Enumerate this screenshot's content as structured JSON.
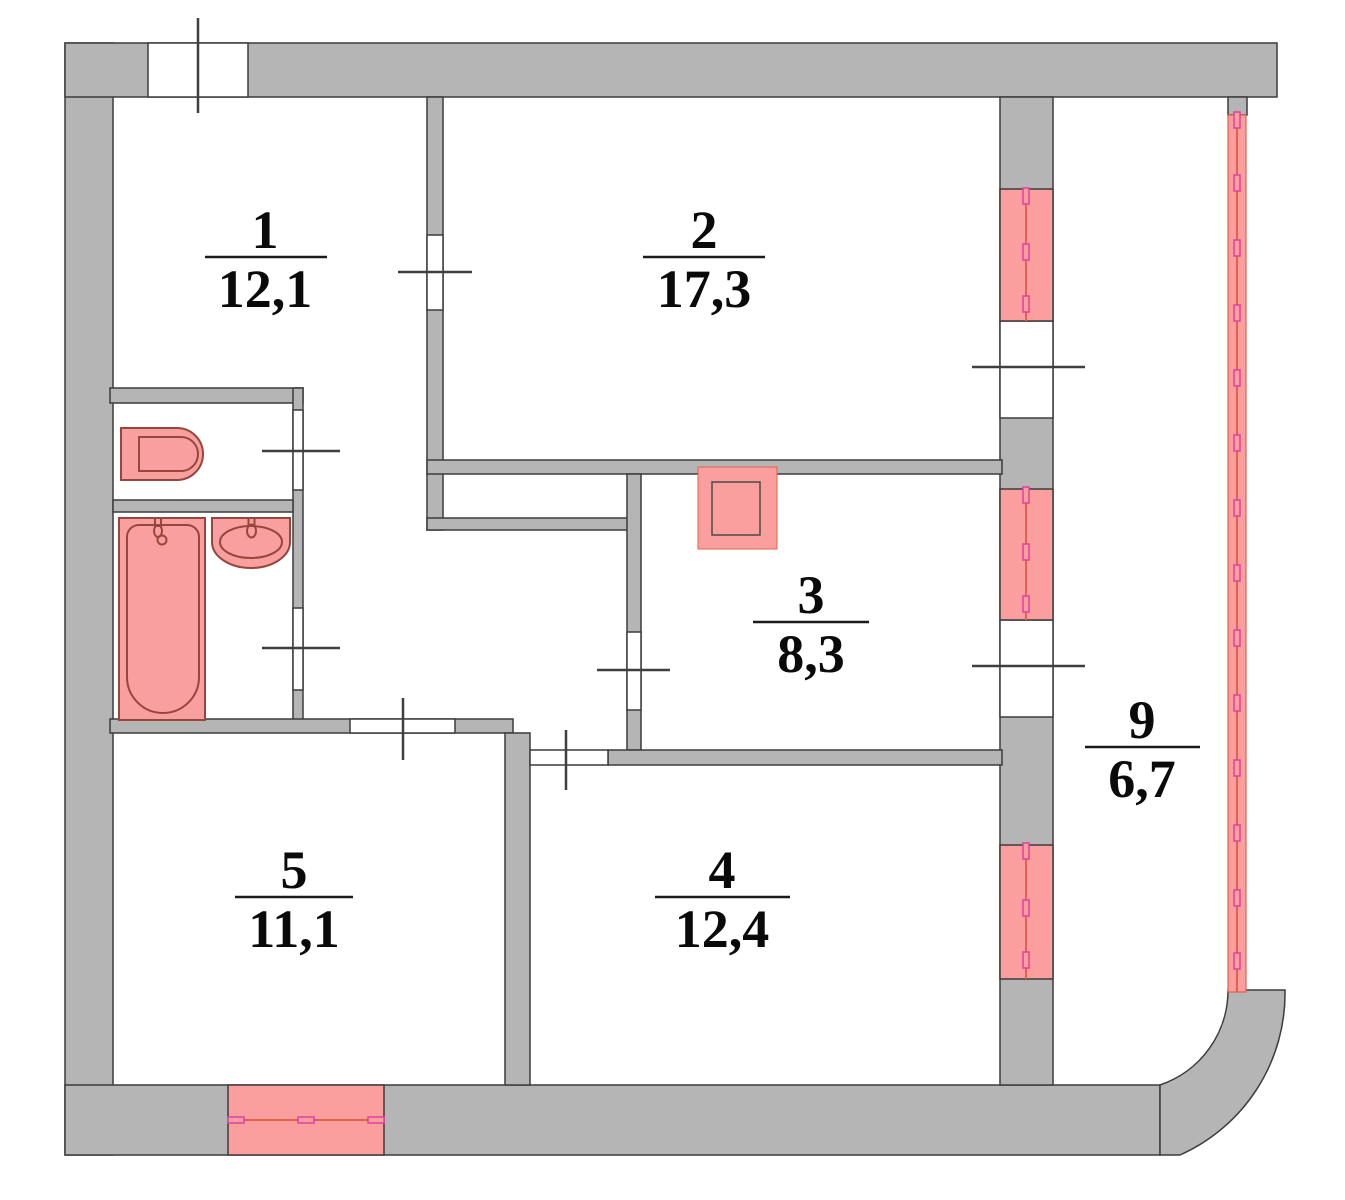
{
  "plan_title": "apartment floor plan",
  "rooms": {
    "r1": {
      "number": "1",
      "area": "12,1"
    },
    "r2": {
      "number": "2",
      "area": "17,3"
    },
    "r3": {
      "number": "3",
      "area": "8,3"
    },
    "r4": {
      "number": "4",
      "area": "12,4"
    },
    "r5": {
      "number": "5",
      "area": "11,1"
    },
    "r9": {
      "number": "9",
      "area": "6,7"
    }
  },
  "colors": {
    "wall_fill": "#b5b5b5",
    "wall_outline": "#3c3c3c",
    "window_fill": "#fb9e9e",
    "window_center_line": "#e2614a",
    "window_pane_mark": "#e0409f",
    "fixture_fill": "#fa9fa0",
    "fixture_outline": "#96473d",
    "label_text": "#0a0a0a",
    "background": "#ffffff"
  },
  "fixtures": {
    "toilet": "toilet",
    "bathtub": "bathtub",
    "sink": "sink",
    "stove": "stove"
  }
}
